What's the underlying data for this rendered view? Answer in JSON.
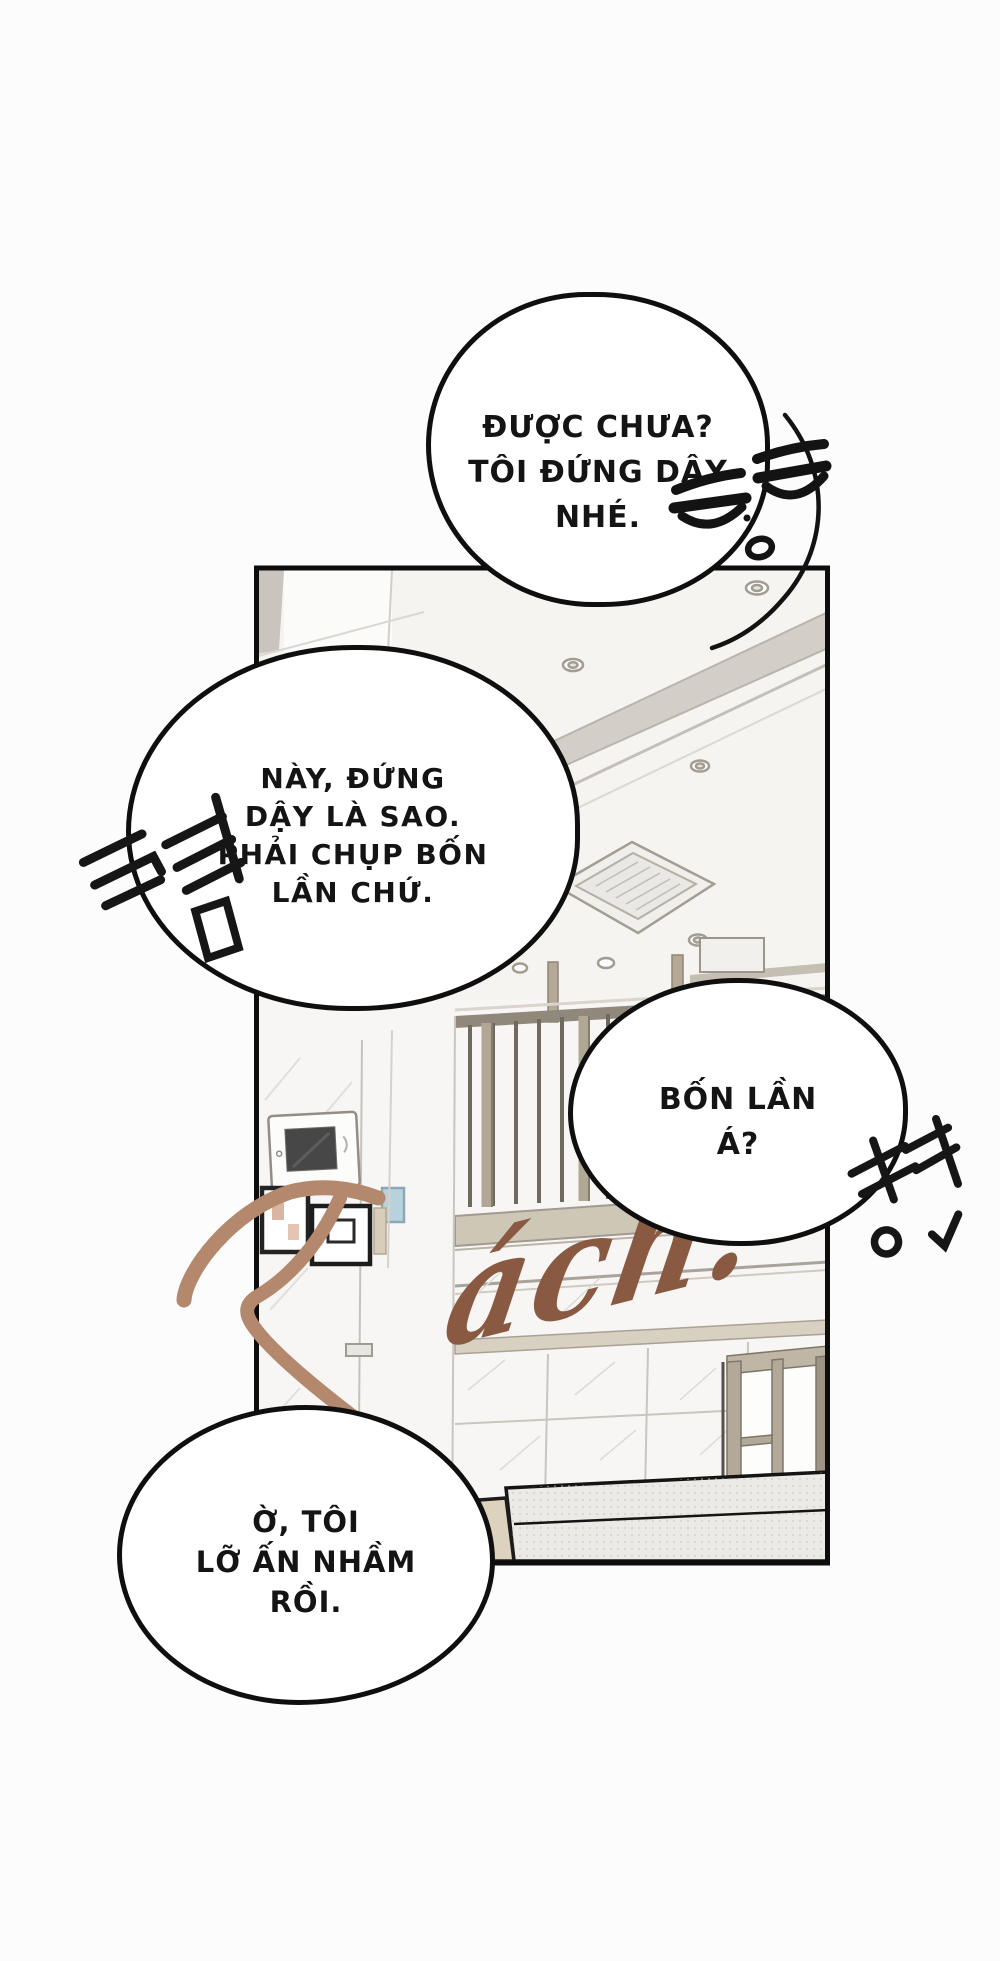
{
  "page": {
    "background": "#fcfcfc",
    "kind": "webtoon-comic-panel"
  },
  "panel": {
    "border_color": "#0d0d0d",
    "fill": "#f7f6f4",
    "description": "apartment interior: ceiling with AC cassette and downlights, loft railing, wall intercom, picture frames, tiled wall, glass door, sofa"
  },
  "bubbles": [
    {
      "name": "speech-bubble-1",
      "lines": [
        "ĐƯỢC CHƯA?",
        "TÔI ĐỨNG DẬY",
        "NHÉ."
      ]
    },
    {
      "name": "speech-bubble-2",
      "lines": [
        "NÀY, ĐỨNG",
        "DẬY LÀ SAO.",
        "PHẢI CHỤP BỐN",
        "LẦN CHỨ."
      ]
    },
    {
      "name": "speech-bubble-3",
      "lines": [
        "BỐN LẦN",
        "Á?"
      ]
    },
    {
      "name": "speech-bubble-4",
      "lines": [
        "Ờ, TÔI",
        "LỠ ẤN NHẦM",
        "RỒI."
      ]
    }
  ],
  "sfx": {
    "text": "Tách!",
    "t_part": "T",
    "rest_part": "ách!",
    "color_t": "#b3886d",
    "color_rest": "#8a5941"
  },
  "emoticons": {
    "face": "unamused-face",
    "left_korean": "끙끙",
    "right_korean": "네?"
  }
}
